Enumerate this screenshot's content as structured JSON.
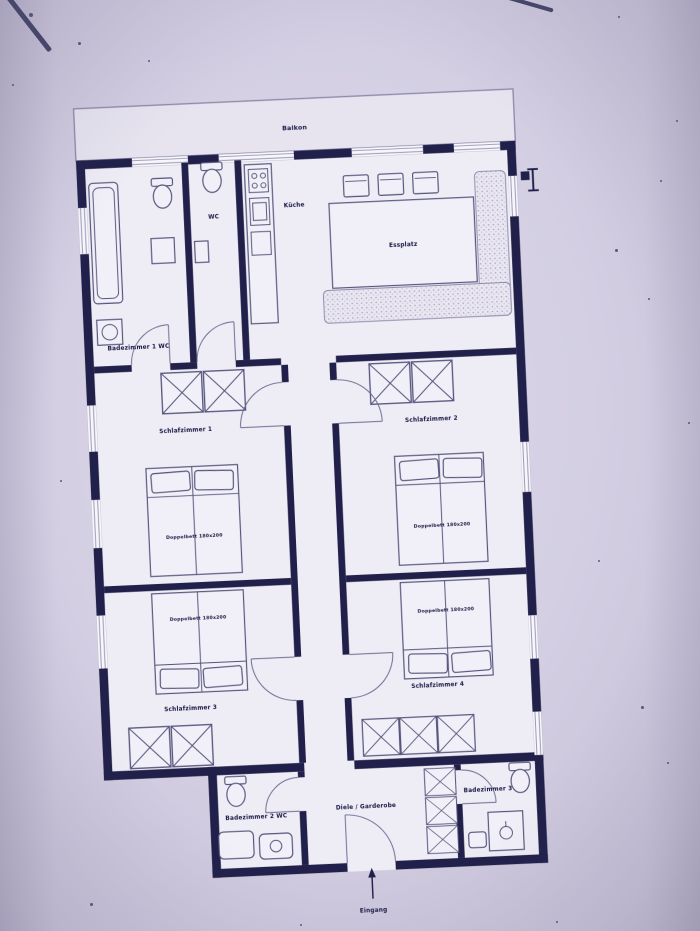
{
  "photo": {
    "background_color": "#d4cfe3",
    "wall_color": "#20204a",
    "furniture_line_color": "#54547c",
    "paper_color": "#eeecf5"
  },
  "plan": {
    "balcony_label": "Balkon",
    "rooms": {
      "bath1": "Badezimmer 1 WC",
      "wc": "WC",
      "kitchen": "Küche",
      "dining": "Essplatz",
      "bedroom1": "Schlafzimmer 1",
      "bedroom2": "Schlafzimmer 2",
      "bedroom3": "Schlafzimmer 3",
      "bedroom4": "Schlafzimmer 4",
      "bath2": "Badezimmer 2 WC",
      "bath3": "Badezimmer 3 WC",
      "hall": "Diele / Garderobe",
      "entrance": "Eingang"
    },
    "beds": {
      "bed1": "Doppelbett 180x200",
      "bed2": "Doppelbett 180x200",
      "bed3": "Doppelbett 180x200",
      "bed4": "Doppelbett 180x200"
    }
  }
}
